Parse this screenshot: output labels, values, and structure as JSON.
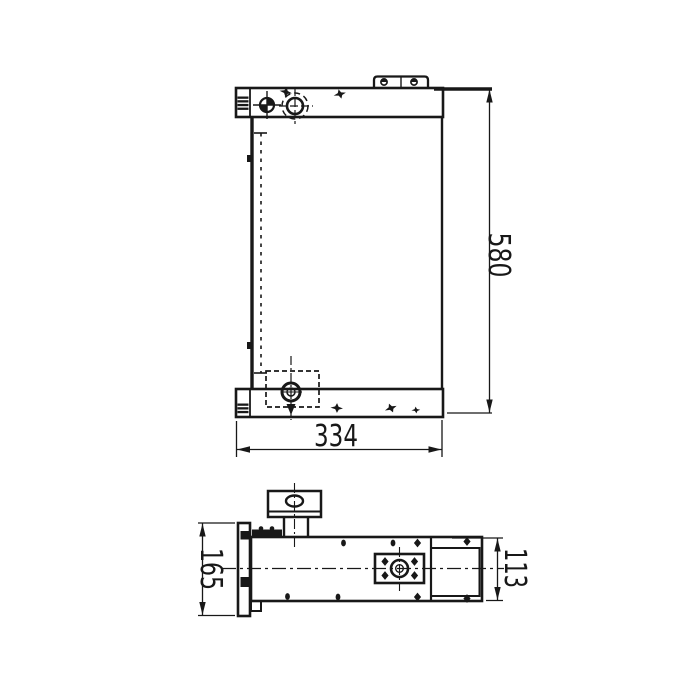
{
  "canvas": {
    "background": "#ffffff",
    "ink": "#1a1a1a"
  },
  "drawing": {
    "kind": "engineering-outline-drawing",
    "views": {
      "front": {
        "name": "front-view",
        "width_label": "334",
        "height_label": "580"
      },
      "side": {
        "name": "side-view",
        "flange_height_label": "165",
        "body_height_label": "113"
      }
    }
  }
}
